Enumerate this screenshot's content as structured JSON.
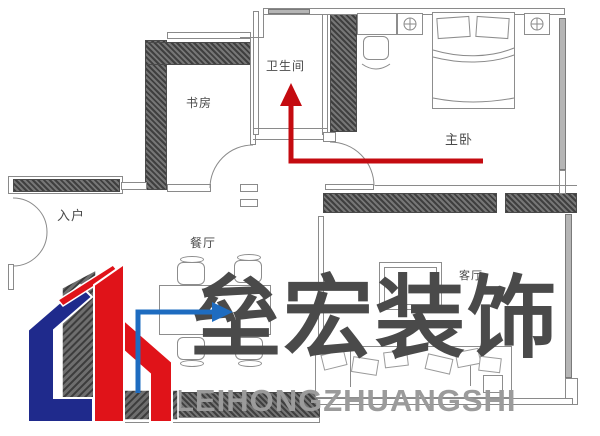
{
  "rooms": {
    "study": "书房",
    "bathroom": "卫生间",
    "master_bedroom": "主卧",
    "entry": "入户",
    "dining": "餐厅",
    "living": "客厅"
  },
  "watermark": {
    "cn": "垒宏装饰",
    "en": "LEIHONGZHUANGSHI"
  },
  "colors": {
    "wall_hatch": "#4a4a4a",
    "plan_line": "#8a8a8a",
    "red_route_arrow": "#c40b10",
    "blue_route_arrow": "#1e6cc0",
    "logo_blue": "#1f2a8c",
    "logo_red": "#e01319",
    "watermark_cn": "#4a4a4a",
    "watermark_en": "#9b9b9b"
  }
}
